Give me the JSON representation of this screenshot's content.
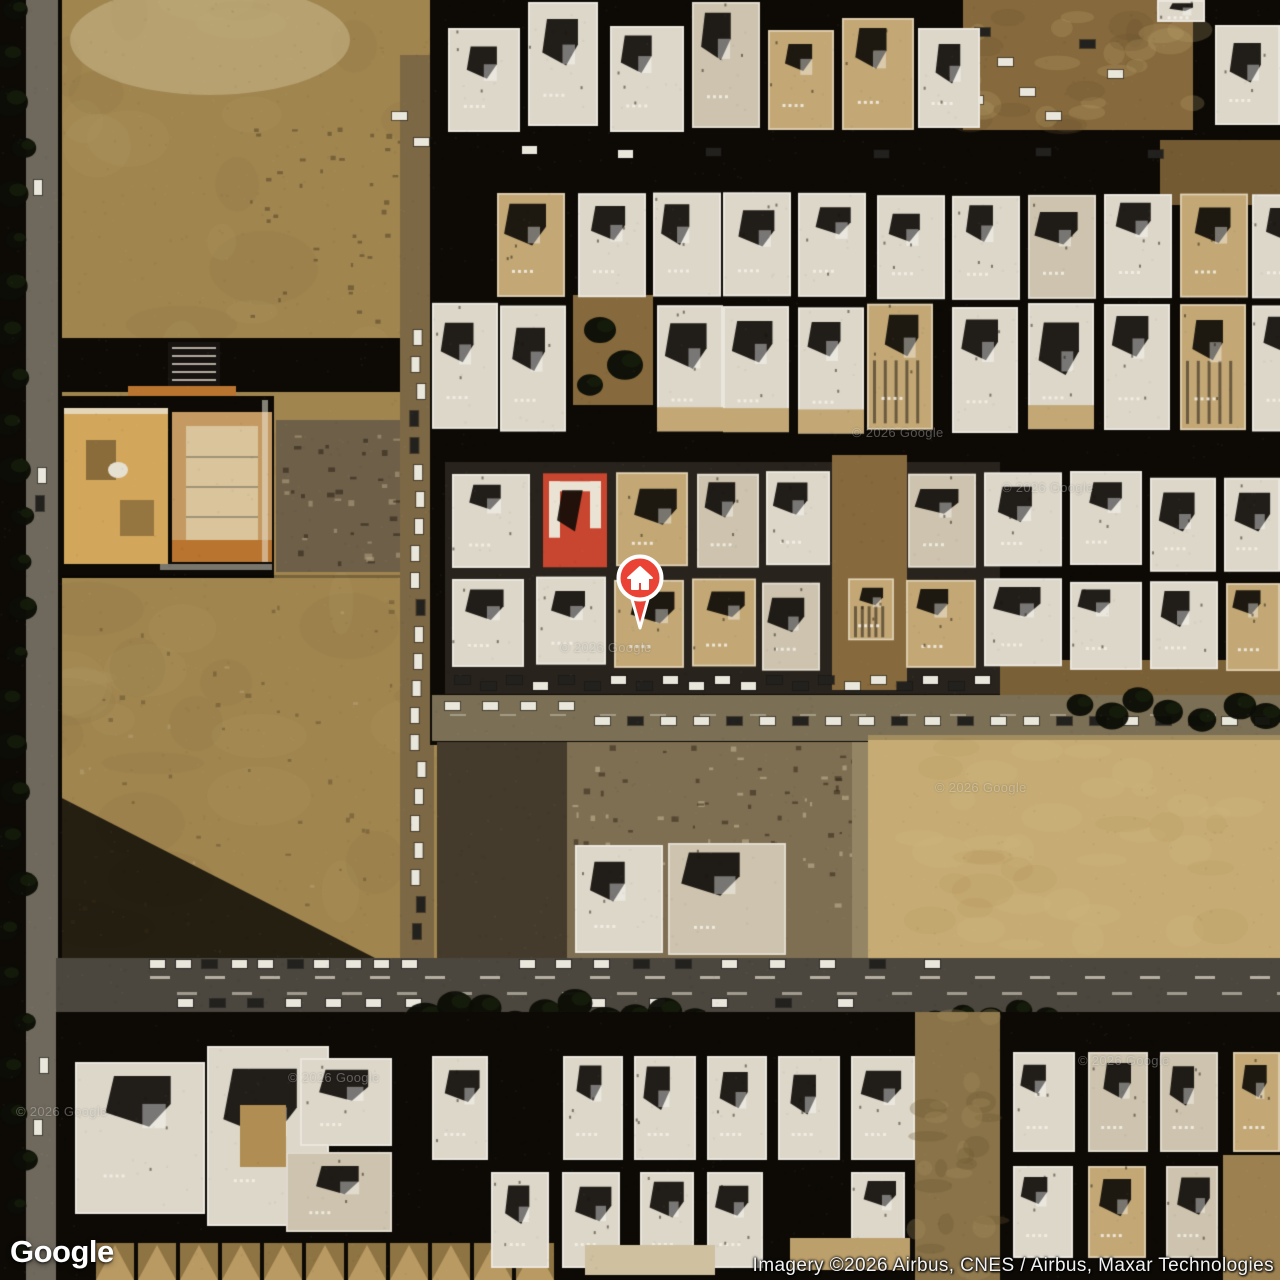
{
  "branding": {
    "logo_text": "Google"
  },
  "attribution": {
    "text": "Imagery ©2026 Airbus, CNES / Airbus, Maxar Technologies"
  },
  "watermark": {
    "text": "© 2026 Google"
  },
  "marker": {
    "type": "place-marker",
    "icon": "home-icon",
    "fill": "#EA4335",
    "ring": "#FFFFFF",
    "x": 640,
    "y": 578
  },
  "colors": {
    "shadow": "#0D0A06",
    "dirt": "#A0854F",
    "dirtLight": "#BBA36C",
    "dirtDark": "#86693C",
    "sand": "#C6AC74",
    "rubble": "#7E6E52",
    "road": "#6F695D",
    "asphalt": "#4B463E",
    "roofWhite": "#DDD7C9",
    "roofCream": "#CDC3AE",
    "roofTan": "#C3A876",
    "roofRed": "#C8452F",
    "courtOrange": "#C59A62",
    "courtInner": "#D9C49C",
    "mosqueGold": "#D2A75C",
    "orangeBand": "#B9742F",
    "carLight": "#E9E6DC",
    "carDark": "#23211E",
    "tree": "#0B0E06",
    "laneMark": "#D8D3C4"
  }
}
